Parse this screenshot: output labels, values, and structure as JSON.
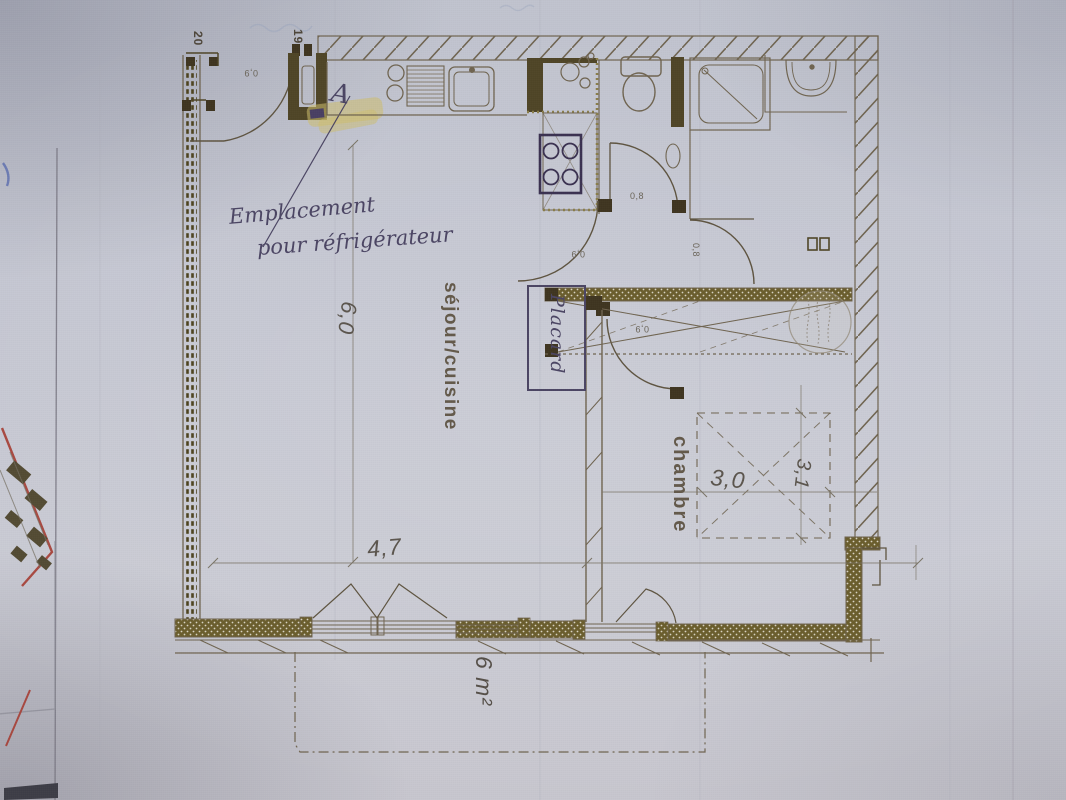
{
  "plan": {
    "room_labels": {
      "living": "séjour/cuisine",
      "bedroom": "chambre",
      "closet": "Placard"
    },
    "dimensions": {
      "living_depth": "6,0",
      "living_width": "4,7",
      "bedroom_width": "3,0",
      "bedroom_depth": "3,1",
      "balcony_area": "6 m²"
    },
    "door_numbers": {
      "left_unit": "20",
      "entry_unit": "19"
    },
    "door_widths": {
      "entry": "0,9",
      "wc": "0,8",
      "hall": "0,9",
      "bathroom": "0,8",
      "bedroom": "0,9"
    },
    "handwritten_note": {
      "line1": "Emplacement",
      "line2": "pour réfrigérateur",
      "mark": "A"
    },
    "colors": {
      "paper": "#c3c5cf",
      "plan_ink": "#6f6450",
      "wall_dark": "#554a28",
      "stove_ink": "#3a3150",
      "highlighter": "#d4c478",
      "handwriting_ink": "#4b4563",
      "underlying_plan_edge": "#a63f35"
    }
  }
}
